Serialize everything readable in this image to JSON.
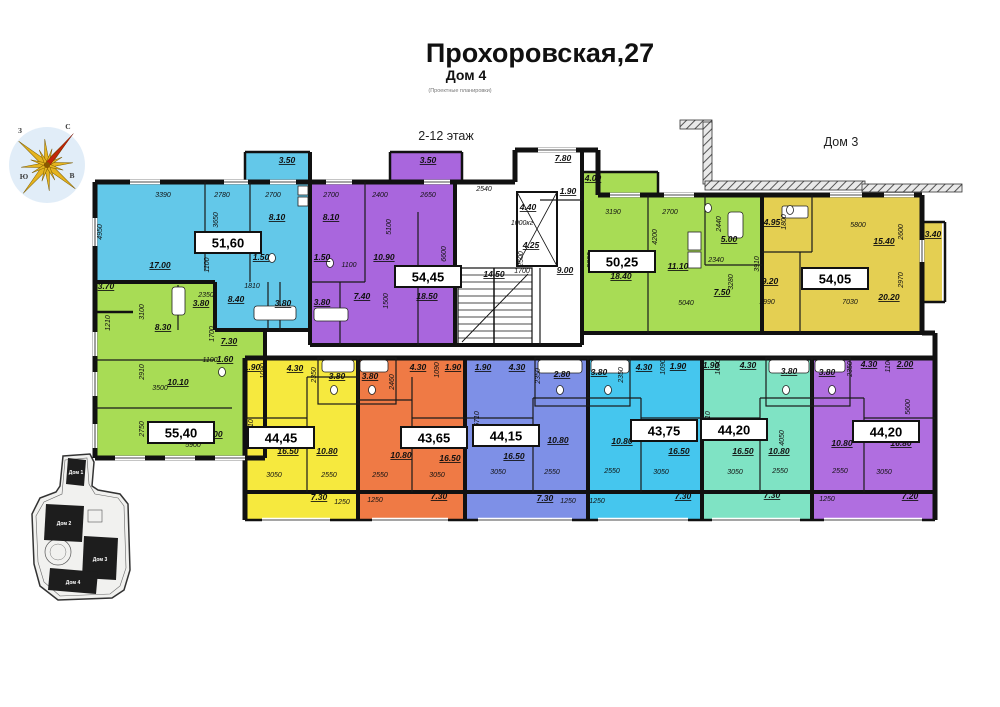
{
  "header": {
    "title": "Прохоровская,27",
    "subtitle": "Дом 4",
    "note": "(Проектные планировки)",
    "floor_label": "2-12 этаж",
    "adjacent_building_label": "Дом 3"
  },
  "compass": {
    "n": "С",
    "e": "В",
    "s": "Ю",
    "w": "З"
  },
  "site_plan": {
    "buildings": [
      "Дом 1",
      "Дом 2",
      "Дом 3",
      "Дом 4"
    ]
  },
  "plan": {
    "apartments": [
      {
        "label": "51,60",
        "x": 228,
        "y": 243,
        "color": "#63c8e9"
      },
      {
        "label": "54,45",
        "x": 428,
        "y": 277,
        "color": "#a966dd"
      },
      {
        "label": "50,25",
        "x": 622,
        "y": 262,
        "color": "#a8dc55"
      },
      {
        "label": "54,05",
        "x": 835,
        "y": 279,
        "color": "#e4cf52"
      },
      {
        "label": "55,40",
        "x": 181,
        "y": 433,
        "color": "#a8dc55"
      },
      {
        "label": "44,45",
        "x": 281,
        "y": 438,
        "color": "#f6e93e"
      },
      {
        "label": "43,65",
        "x": 434,
        "y": 438,
        "color": "#ef7a45"
      },
      {
        "label": "44,15",
        "x": 506,
        "y": 436,
        "color": "#7e90e7"
      },
      {
        "label": "43,75",
        "x": 664,
        "y": 431,
        "color": "#45c6ee"
      },
      {
        "label": "44,20",
        "x": 734,
        "y": 430,
        "color": "#7fe3c4"
      },
      {
        "label": "44,20",
        "x": 886,
        "y": 432,
        "color": "#b06ee0"
      }
    ],
    "annotations": [
      {
        "t": "3.50",
        "x": 287,
        "y": 163,
        "k": "a"
      },
      {
        "t": "3390",
        "x": 163,
        "y": 197,
        "k": "d"
      },
      {
        "t": "2780",
        "x": 222,
        "y": 197,
        "k": "d"
      },
      {
        "t": "2700",
        "x": 273,
        "y": 197,
        "k": "d"
      },
      {
        "t": "4950",
        "x": 102,
        "y": 232,
        "r": -90,
        "k": "d"
      },
      {
        "t": "3650",
        "x": 218,
        "y": 220,
        "r": -90,
        "k": "d"
      },
      {
        "t": "17.00",
        "x": 160,
        "y": 268,
        "k": "a"
      },
      {
        "t": "10.20",
        "x": 228,
        "y": 250,
        "k": "a"
      },
      {
        "t": "8.10",
        "x": 277,
        "y": 220,
        "k": "a"
      },
      {
        "t": "1100",
        "x": 209,
        "y": 265,
        "r": -90,
        "k": "d"
      },
      {
        "t": "1810",
        "x": 252,
        "y": 288,
        "k": "d"
      },
      {
        "t": "8.40",
        "x": 236,
        "y": 302,
        "k": "a"
      },
      {
        "t": "1.50",
        "x": 261,
        "y": 260,
        "k": "a"
      },
      {
        "t": "3.80",
        "x": 283,
        "y": 306,
        "k": "a"
      },
      {
        "t": "3.50",
        "x": 428,
        "y": 163,
        "k": "a"
      },
      {
        "t": "2700",
        "x": 331,
        "y": 197,
        "k": "d"
      },
      {
        "t": "2400",
        "x": 380,
        "y": 197,
        "k": "d"
      },
      {
        "t": "2650",
        "x": 428,
        "y": 197,
        "k": "d"
      },
      {
        "t": "5100",
        "x": 391,
        "y": 227,
        "r": -90,
        "k": "d"
      },
      {
        "t": "6600",
        "x": 446,
        "y": 254,
        "r": -90,
        "k": "d"
      },
      {
        "t": "8.10",
        "x": 331,
        "y": 220,
        "k": "a"
      },
      {
        "t": "1.50",
        "x": 322,
        "y": 260,
        "k": "a"
      },
      {
        "t": "10.90",
        "x": 384,
        "y": 260,
        "k": "a"
      },
      {
        "t": "1100",
        "x": 349,
        "y": 267,
        "k": "d"
      },
      {
        "t": "1500",
        "x": 388,
        "y": 301,
        "r": -90,
        "k": "d"
      },
      {
        "t": "3.80",
        "x": 322,
        "y": 305,
        "k": "a"
      },
      {
        "t": "7.40",
        "x": 362,
        "y": 299,
        "k": "a"
      },
      {
        "t": "18.50",
        "x": 427,
        "y": 299,
        "k": "a"
      },
      {
        "t": "7.80",
        "x": 563,
        "y": 161,
        "k": "a"
      },
      {
        "t": "2540",
        "x": 484,
        "y": 191,
        "k": "d"
      },
      {
        "t": "1.90",
        "x": 568,
        "y": 194,
        "k": "a"
      },
      {
        "t": "4.40",
        "x": 528,
        "y": 210,
        "k": "a"
      },
      {
        "t": "1000кг",
        "x": 522,
        "y": 225,
        "k": "d"
      },
      {
        "t": "4.25",
        "x": 531,
        "y": 248,
        "k": "a"
      },
      {
        "t": "2500",
        "x": 523,
        "y": 259,
        "r": -90,
        "k": "d"
      },
      {
        "t": "1700",
        "x": 522,
        "y": 273,
        "k": "d"
      },
      {
        "t": "9.00",
        "x": 565,
        "y": 273,
        "k": "a"
      },
      {
        "t": "14.50",
        "x": 494,
        "y": 277,
        "k": "a"
      },
      {
        "t": "4.00",
        "x": 593,
        "y": 181,
        "k": "a"
      },
      {
        "t": "3190",
        "x": 613,
        "y": 214,
        "k": "d"
      },
      {
        "t": "2700",
        "x": 670,
        "y": 214,
        "k": "d"
      },
      {
        "t": "4200",
        "x": 657,
        "y": 237,
        "r": -90,
        "k": "d"
      },
      {
        "t": "5800",
        "x": 592,
        "y": 260,
        "r": -90,
        "k": "d"
      },
      {
        "t": "18.40",
        "x": 621,
        "y": 279,
        "k": "a"
      },
      {
        "t": "11.10",
        "x": 678,
        "y": 269,
        "k": "a"
      },
      {
        "t": "2440",
        "x": 721,
        "y": 224,
        "r": -90,
        "k": "d"
      },
      {
        "t": "5.00",
        "x": 729,
        "y": 242,
        "k": "a"
      },
      {
        "t": "2340",
        "x": 716,
        "y": 262,
        "k": "d"
      },
      {
        "t": "3280",
        "x": 733,
        "y": 282,
        "r": -90,
        "k": "d"
      },
      {
        "t": "7.50",
        "x": 722,
        "y": 295,
        "k": "a"
      },
      {
        "t": "5040",
        "x": 686,
        "y": 305,
        "k": "d"
      },
      {
        "t": "4.95",
        "x": 772,
        "y": 225,
        "k": "a"
      },
      {
        "t": "1800",
        "x": 786,
        "y": 222,
        "r": -90,
        "k": "d"
      },
      {
        "t": "5800",
        "x": 858,
        "y": 227,
        "k": "d"
      },
      {
        "t": "2600",
        "x": 903,
        "y": 232,
        "r": -90,
        "k": "d"
      },
      {
        "t": "15.40",
        "x": 884,
        "y": 244,
        "k": "a"
      },
      {
        "t": "3.40",
        "x": 933,
        "y": 237,
        "k": "a"
      },
      {
        "t": "3910",
        "x": 759,
        "y": 264,
        "r": -90,
        "k": "d"
      },
      {
        "t": "9.20",
        "x": 770,
        "y": 284,
        "k": "a"
      },
      {
        "t": "2970",
        "x": 903,
        "y": 280,
        "r": -90,
        "k": "d"
      },
      {
        "t": "1990",
        "x": 767,
        "y": 304,
        "k": "d"
      },
      {
        "t": "7030",
        "x": 850,
        "y": 304,
        "k": "d"
      },
      {
        "t": "20.20",
        "x": 889,
        "y": 300,
        "k": "a"
      },
      {
        "t": "3.70",
        "x": 106,
        "y": 289,
        "k": "a"
      },
      {
        "t": "1210",
        "x": 110,
        "y": 323,
        "r": -90,
        "k": "d"
      },
      {
        "t": "3100",
        "x": 144,
        "y": 312,
        "r": -90,
        "k": "d"
      },
      {
        "t": "2350",
        "x": 206,
        "y": 297,
        "k": "d"
      },
      {
        "t": "3.80",
        "x": 201,
        "y": 306,
        "k": "a"
      },
      {
        "t": "8.30",
        "x": 163,
        "y": 330,
        "k": "a"
      },
      {
        "t": "1700",
        "x": 214,
        "y": 334,
        "r": -90,
        "k": "d"
      },
      {
        "t": "7.30",
        "x": 229,
        "y": 344,
        "k": "a"
      },
      {
        "t": "1100",
        "x": 210,
        "y": 362,
        "k": "d"
      },
      {
        "t": "1.60",
        "x": 225,
        "y": 362,
        "k": "a"
      },
      {
        "t": "2910",
        "x": 144,
        "y": 372,
        "r": -90,
        "k": "d"
      },
      {
        "t": "3500",
        "x": 160,
        "y": 390,
        "k": "d"
      },
      {
        "t": "10.10",
        "x": 178,
        "y": 385,
        "k": "a"
      },
      {
        "t": "2750",
        "x": 144,
        "y": 429,
        "r": -90,
        "k": "d"
      },
      {
        "t": "17.00",
        "x": 212,
        "y": 437,
        "k": "a"
      },
      {
        "t": "5900",
        "x": 193,
        "y": 447,
        "k": "d"
      },
      {
        "t": "1.90",
        "x": 252,
        "y": 370,
        "k": "a"
      },
      {
        "t": "1090",
        "x": 265,
        "y": 371,
        "r": -90,
        "k": "d"
      },
      {
        "t": "4.30",
        "x": 295,
        "y": 371,
        "k": "a"
      },
      {
        "t": "2350",
        "x": 316,
        "y": 375,
        "r": -90,
        "k": "d"
      },
      {
        "t": "3.80",
        "x": 337,
        "y": 379,
        "k": "a"
      },
      {
        "t": "5710",
        "x": 253,
        "y": 427,
        "r": -90,
        "k": "d"
      },
      {
        "t": "16.50",
        "x": 288,
        "y": 454,
        "k": "a"
      },
      {
        "t": "10.80",
        "x": 327,
        "y": 454,
        "k": "a"
      },
      {
        "t": "3050",
        "x": 274,
        "y": 477,
        "k": "d"
      },
      {
        "t": "2550",
        "x": 329,
        "y": 477,
        "k": "d"
      },
      {
        "t": "7.30",
        "x": 319,
        "y": 500,
        "k": "a"
      },
      {
        "t": "1250",
        "x": 342,
        "y": 504,
        "k": "d"
      },
      {
        "t": "3.80",
        "x": 370,
        "y": 379,
        "k": "a"
      },
      {
        "t": "2460",
        "x": 394,
        "y": 382,
        "r": -90,
        "k": "d"
      },
      {
        "t": "4.30",
        "x": 418,
        "y": 370,
        "k": "a"
      },
      {
        "t": "1090",
        "x": 439,
        "y": 370,
        "r": -90,
        "k": "d"
      },
      {
        "t": "1.90",
        "x": 453,
        "y": 370,
        "k": "a"
      },
      {
        "t": "10.80",
        "x": 401,
        "y": 458,
        "k": "a"
      },
      {
        "t": "16.50",
        "x": 450,
        "y": 461,
        "k": "a"
      },
      {
        "t": "2550",
        "x": 380,
        "y": 477,
        "k": "d"
      },
      {
        "t": "3050",
        "x": 437,
        "y": 477,
        "k": "d"
      },
      {
        "t": "1250",
        "x": 375,
        "y": 502,
        "k": "d"
      },
      {
        "t": "7.30",
        "x": 439,
        "y": 499,
        "k": "a"
      },
      {
        "t": "1.90",
        "x": 483,
        "y": 370,
        "k": "a"
      },
      {
        "t": "4.30",
        "x": 517,
        "y": 370,
        "k": "a"
      },
      {
        "t": "5710",
        "x": 479,
        "y": 419,
        "r": -90,
        "k": "d"
      },
      {
        "t": "2350",
        "x": 540,
        "y": 376,
        "r": -90,
        "k": "d"
      },
      {
        "t": "2.80",
        "x": 562,
        "y": 377,
        "k": "a"
      },
      {
        "t": "16.50",
        "x": 514,
        "y": 459,
        "k": "a"
      },
      {
        "t": "10.80",
        "x": 558,
        "y": 443,
        "k": "a"
      },
      {
        "t": "3050",
        "x": 498,
        "y": 474,
        "k": "d"
      },
      {
        "t": "2550",
        "x": 552,
        "y": 474,
        "k": "d"
      },
      {
        "t": "7.30",
        "x": 545,
        "y": 501,
        "k": "a"
      },
      {
        "t": "1250",
        "x": 568,
        "y": 503,
        "k": "d"
      },
      {
        "t": "3.80",
        "x": 599,
        "y": 375,
        "k": "a"
      },
      {
        "t": "2350",
        "x": 623,
        "y": 375,
        "r": -90,
        "k": "d"
      },
      {
        "t": "4.30",
        "x": 644,
        "y": 370,
        "k": "a"
      },
      {
        "t": "1090",
        "x": 665,
        "y": 367,
        "r": -90,
        "k": "d"
      },
      {
        "t": "1.90",
        "x": 678,
        "y": 369,
        "k": "a"
      },
      {
        "t": "10.80",
        "x": 622,
        "y": 444,
        "k": "a"
      },
      {
        "t": "16.50",
        "x": 679,
        "y": 454,
        "k": "a"
      },
      {
        "t": "2550",
        "x": 612,
        "y": 473,
        "k": "d"
      },
      {
        "t": "3050",
        "x": 661,
        "y": 474,
        "k": "d"
      },
      {
        "t": "1250",
        "x": 597,
        "y": 503,
        "k": "d"
      },
      {
        "t": "7.30",
        "x": 683,
        "y": 499,
        "k": "a"
      },
      {
        "t": "1.90",
        "x": 711,
        "y": 368,
        "k": "a"
      },
      {
        "t": "1090",
        "x": 720,
        "y": 367,
        "r": -90,
        "k": "d"
      },
      {
        "t": "4.30",
        "x": 748,
        "y": 368,
        "k": "a"
      },
      {
        "t": "5710",
        "x": 710,
        "y": 419,
        "r": -90,
        "k": "d"
      },
      {
        "t": "3.80",
        "x": 789,
        "y": 374,
        "k": "a"
      },
      {
        "t": "4050",
        "x": 784,
        "y": 438,
        "r": -90,
        "k": "d"
      },
      {
        "t": "16.50",
        "x": 743,
        "y": 454,
        "k": "a"
      },
      {
        "t": "10.80",
        "x": 779,
        "y": 454,
        "k": "a"
      },
      {
        "t": "3050",
        "x": 735,
        "y": 474,
        "k": "d"
      },
      {
        "t": "2550",
        "x": 780,
        "y": 473,
        "k": "d"
      },
      {
        "t": "7.30",
        "x": 772,
        "y": 498,
        "k": "a"
      },
      {
        "t": "3.80",
        "x": 827,
        "y": 375,
        "k": "a"
      },
      {
        "t": "2350",
        "x": 852,
        "y": 369,
        "r": -90,
        "k": "d"
      },
      {
        "t": "4.30",
        "x": 869,
        "y": 367,
        "k": "a"
      },
      {
        "t": "1100",
        "x": 890,
        "y": 365,
        "r": -90,
        "k": "d"
      },
      {
        "t": "2.00",
        "x": 905,
        "y": 367,
        "k": "a"
      },
      {
        "t": "5600",
        "x": 910,
        "y": 407,
        "r": -90,
        "k": "d"
      },
      {
        "t": "10.80",
        "x": 842,
        "y": 446,
        "k": "a"
      },
      {
        "t": "16.80",
        "x": 901,
        "y": 446,
        "k": "a"
      },
      {
        "t": "2550",
        "x": 840,
        "y": 473,
        "k": "d"
      },
      {
        "t": "3050",
        "x": 884,
        "y": 474,
        "k": "d"
      },
      {
        "t": "1250",
        "x": 827,
        "y": 501,
        "k": "d"
      },
      {
        "t": "7.20",
        "x": 910,
        "y": 499,
        "k": "a"
      }
    ]
  }
}
